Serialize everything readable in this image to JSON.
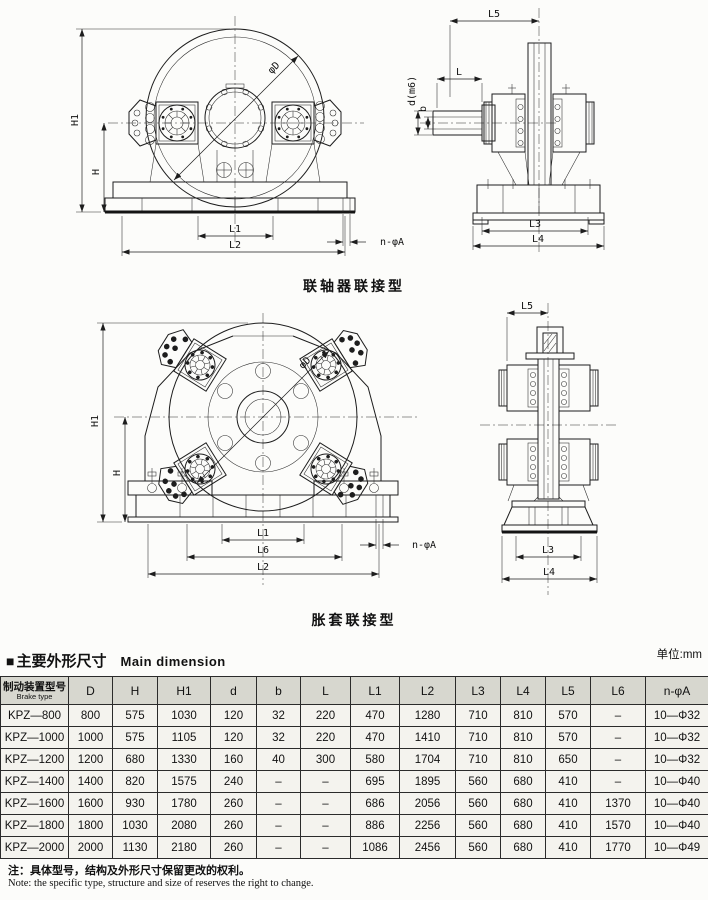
{
  "captions": {
    "coupling": "联轴器联接型",
    "sleeve": "胀套联接型"
  },
  "section": {
    "marker": "■",
    "title_cn": "主要外形尺寸",
    "title_en": "Main dimension",
    "unit": "单位:mm"
  },
  "notes": {
    "cn": "注：具体型号，结构及外形尺寸保留更改的权利。",
    "en": "Note: the specific type, structure and size of reserves the right to change."
  },
  "drawings": {
    "coupling_front": {
      "labels": {
        "H1": "H1",
        "H": "H",
        "L1": "L1",
        "L2": "L2",
        "nA": "n-φA",
        "phiD": "φD"
      }
    },
    "coupling_side": {
      "labels": {
        "L5": "L5",
        "L": "L",
        "d": "d(m6)",
        "b": "b",
        "L3": "L3",
        "L4": "L4"
      }
    },
    "sleeve_front": {
      "labels": {
        "H1": "H1",
        "H": "H",
        "L1": "L1",
        "L6": "L6",
        "L2": "L2",
        "nA": "n-φA",
        "phiD": "φD"
      }
    },
    "sleeve_side": {
      "labels": {
        "L5": "L5",
        "L3": "L3",
        "L4": "L4"
      }
    }
  },
  "table": {
    "model_header_cn": "制动装置型号",
    "model_header_en": "Brake type",
    "columns": [
      "D",
      "H",
      "H1",
      "d",
      "b",
      "L",
      "L1",
      "L2",
      "L3",
      "L4",
      "L5",
      "L6",
      "n-φA"
    ],
    "rows": [
      {
        "model": "KPZ—800",
        "values": [
          "800",
          "575",
          "1030",
          "120",
          "32",
          "220",
          "470",
          "1280",
          "710",
          "810",
          "570",
          "–",
          "10—Φ32"
        ]
      },
      {
        "model": "KPZ—1000",
        "values": [
          "1000",
          "575",
          "1105",
          "120",
          "32",
          "220",
          "470",
          "1410",
          "710",
          "810",
          "570",
          "–",
          "10—Φ32"
        ]
      },
      {
        "model": "KPZ—1200",
        "values": [
          "1200",
          "680",
          "1330",
          "160",
          "40",
          "300",
          "580",
          "1704",
          "710",
          "810",
          "650",
          "–",
          "10—Φ32"
        ]
      },
      {
        "model": "KPZ—1400",
        "values": [
          "1400",
          "820",
          "1575",
          "240",
          "–",
          "–",
          "695",
          "1895",
          "560",
          "680",
          "410",
          "–",
          "10—Φ40"
        ]
      },
      {
        "model": "KPZ—1600",
        "values": [
          "1600",
          "930",
          "1780",
          "260",
          "–",
          "–",
          "686",
          "2056",
          "560",
          "680",
          "410",
          "1370",
          "10—Φ40"
        ]
      },
      {
        "model": "KPZ—1800",
        "values": [
          "1800",
          "1030",
          "2080",
          "260",
          "–",
          "–",
          "886",
          "2256",
          "560",
          "680",
          "410",
          "1570",
          "10—Φ40"
        ]
      },
      {
        "model": "KPZ—2000",
        "values": [
          "2000",
          "1130",
          "2180",
          "260",
          "–",
          "–",
          "1086",
          "2456",
          "560",
          "680",
          "410",
          "1770",
          "10—Φ49"
        ]
      }
    ]
  }
}
